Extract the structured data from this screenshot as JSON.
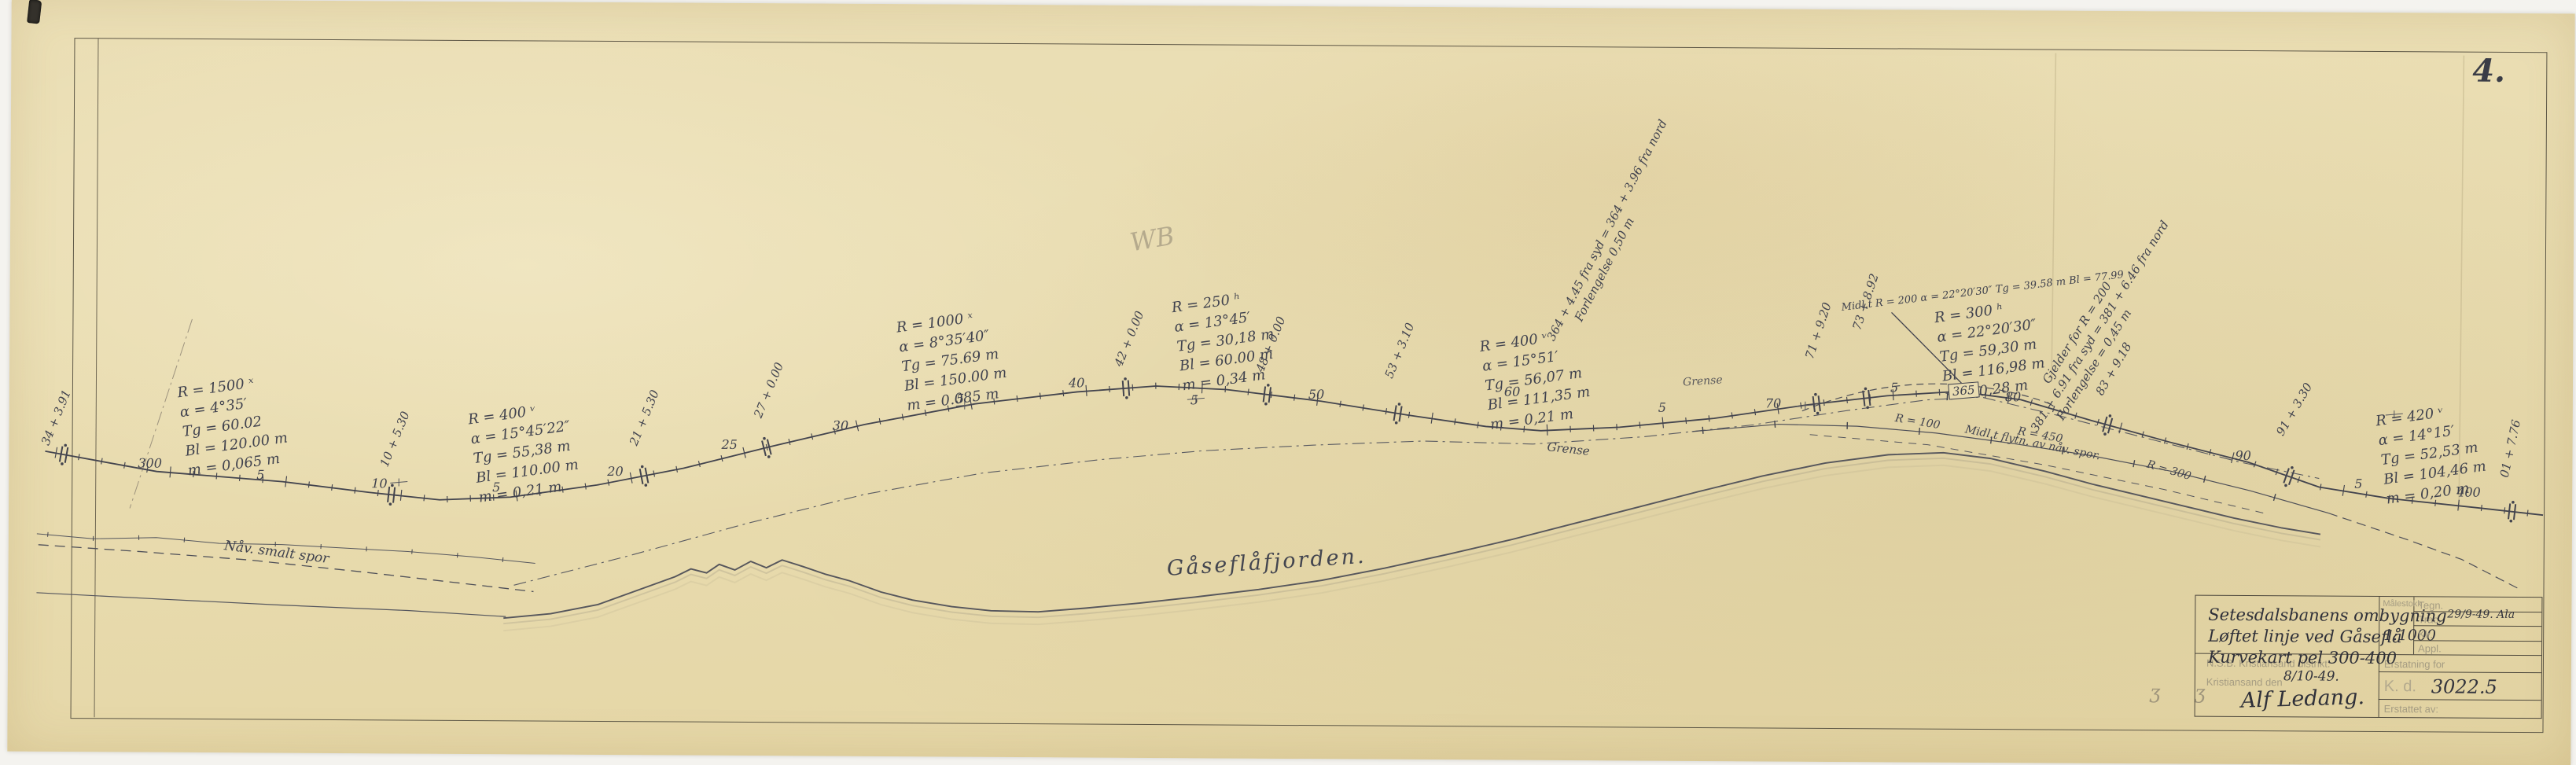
{
  "page": {
    "number": "4."
  },
  "colors": {
    "paper": "#e8dbae",
    "ink": "#40424e",
    "faint_print": "#a59c82",
    "pencil": "#8b8270"
  },
  "map": {
    "water_label": "Gåseflåfjorden.",
    "old_track_label": "Nåv. smalt spor",
    "grense_label": "Grense",
    "grense_label_2": "Grense",
    "relocation_label": "Midl.t flytn. av nåv. spor.",
    "radius_labels": [
      "R = 100",
      "R = 450",
      "R = 300"
    ],
    "bridge_number": "365",
    "initials": "WB",
    "margin_marks": "ʒ  ʒ",
    "stations": [
      "300",
      "5",
      "10",
      "5",
      "20",
      "25",
      "30",
      "5",
      "40",
      "5",
      "50",
      "60",
      "5",
      "70",
      "5",
      "80",
      "90",
      "5",
      "400"
    ],
    "chainages": [
      "34 + 3.91",
      "10 + 5.30",
      "21 + 5.30",
      "27 + 0.00",
      "42 + 0.00",
      "48 + 0.00",
      "53 + 3.10",
      "71 + 9.20",
      "73 + 8.92",
      "83 + 9.18",
      "91 + 3.30",
      "01 + 7.76"
    ]
  },
  "curves": [
    {
      "r": "R = 1500 ˣ",
      "a": "α = 4°35′",
      "tg": "Tg = 60.02",
      "bl": "Bl = 120.00 m",
      "m": "m = 0,065 m"
    },
    {
      "r": "R = 400 ᵛ",
      "a": "α = 15°45′22″",
      "tg": "Tg = 55,38 m",
      "bl": "Bl = 110.00 m",
      "m": "m = 0,21 m"
    },
    {
      "r": "R = 1000 ˣ",
      "a": "α = 8°35′40″",
      "tg": "Tg = 75.69 m",
      "bl": "Bl = 150.00 m",
      "m": "m = 0.085 m"
    },
    {
      "r": "R = 250 ʰ",
      "a": "α = 13°45′",
      "tg": "Tg = 30,18 m",
      "bl": "Bl = 60.00 m",
      "m": "m = 0,34 m"
    },
    {
      "r": "R = 400 ᵛ",
      "a": "α = 15°51′",
      "tg": "Tg = 56,07 m",
      "bl": "Bl = 111,35 m",
      "m": "m = 0,21 m"
    },
    {
      "r": "R = 300 ʰ",
      "a": "α = 22°20′30″",
      "tg": "Tg = 59,30 m",
      "bl": "Bl = 116,98 m",
      "m": "m = 0,28 m"
    },
    {
      "r": "R = 420 ᵛ",
      "a": "α = 14°15′",
      "tg": "Tg = 52,53 m",
      "bl": "Bl = 104,46 m",
      "m": "m = 0,20 m"
    }
  ],
  "temp_curve_note": {
    "l1": "Midl.t R = 200",
    "l2": "α = 22°20′30″",
    "l3": "Tg = 39.58 m",
    "l4": "Bl = 77.99"
  },
  "notes": [
    {
      "l1": "364 + 4.45 fra syd = 364 + 3.96 fra nord",
      "l2": "Forlengelse 0,50 m"
    },
    {
      "l1": "Gjelder for R = 200",
      "l2": "381 + 6.91 fra syd = 381 + 6.46 fra nord",
      "l3": "Forlengelse = 0,45 m"
    }
  ],
  "title_block": {
    "title_line1": "Setesdalsbanens ombygning",
    "title_line2": "Løftet linje ved Gåseflå",
    "title_line3": "Kurvekart pel 300-400",
    "scale_field_label": "Målestokk",
    "scale_value": "1:1000",
    "row_tegn": "Tegn.",
    "row_trac": "Trac.",
    "row_klr": "Klr.",
    "row_appl": "Appl.",
    "date_note": "29/9-49. Ala",
    "org_line1": "N.S.B. Kristiansand distrikt.",
    "org_line2": "Kristiansand den",
    "date_handwritten": "8/10-49.",
    "signature": "Alf Ledang.",
    "erstatning_label": "Erstatning for",
    "kd_label": "K. d.",
    "drawing_number": "3022.5",
    "erstattet_label": "Erstattet av:"
  }
}
